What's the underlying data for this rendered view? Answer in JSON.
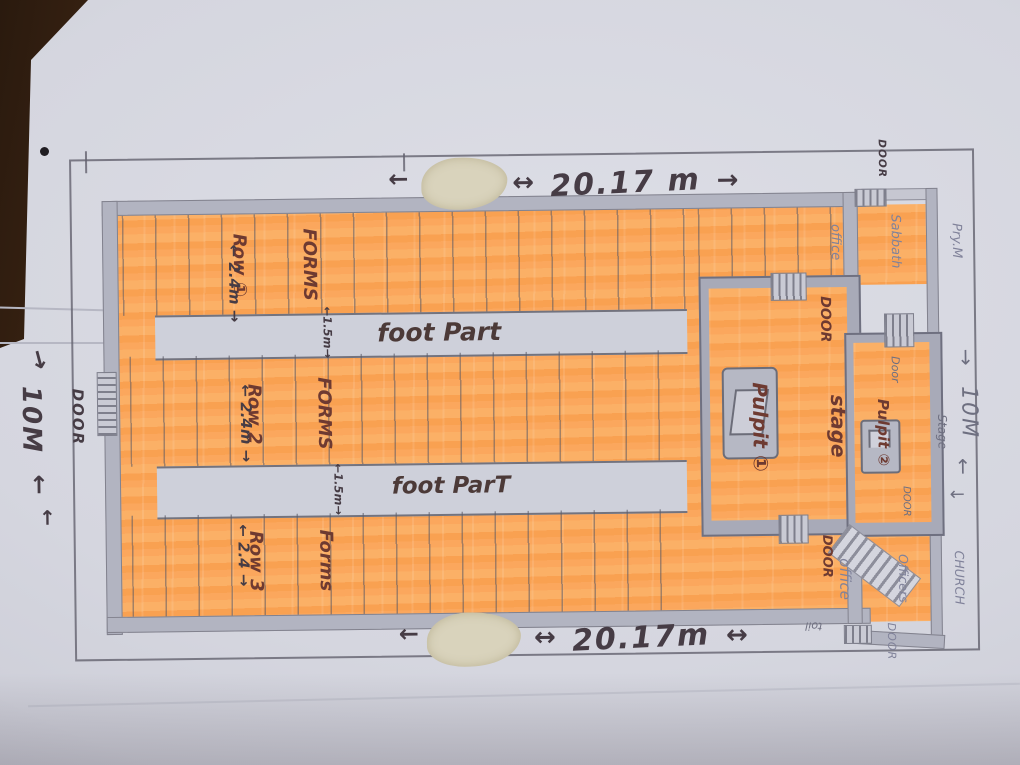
{
  "scene": {
    "description": "Photograph of a hand-drawn church hall floor plan, highlighted in orange marker, on paper lying on a wooden table",
    "colors": {
      "table_wood": "#35200f",
      "paper": "#d5d6df",
      "highlighter_orange": "#faa95c",
      "pencil_gray": "#80829a",
      "marker_brown": "#6e3a31",
      "ink_dark": "#463c45",
      "wall_gray": "#b2b4c1"
    }
  },
  "dimensions": {
    "top": {
      "arrow_left": "←",
      "arrow_mid": "↔",
      "text": "20.17 m",
      "arrow_right": "→"
    },
    "bottom": {
      "arrow_left": "←",
      "arrow_mid": "↔",
      "text": "20.17m",
      "arrow_right": "↔"
    },
    "left": {
      "arrow_top": "↓",
      "text": "10M",
      "arrow_bottom": "↑",
      "arrow_bottom2": "↑"
    },
    "right": {
      "arrow_top": "↓",
      "text": "10M",
      "arrow_bottom": "↑",
      "arrow_side": "←"
    }
  },
  "seating": {
    "rows": [
      {
        "line1": "FORMS",
        "line2": "Row ①",
        "width": "← 2.4m →"
      },
      {
        "line1": "FORMS",
        "line2": "Row 2",
        "width": "← 2.4m →"
      },
      {
        "line1": "Forms",
        "line2": "Row 3",
        "width": "← 2.4 →"
      }
    ],
    "walkways": [
      {
        "label": "foot Part",
        "width": "←1.5m→"
      },
      {
        "label": "foot ParT",
        "width": "←1.5m→"
      }
    ]
  },
  "stage": {
    "stage1": {
      "line1": "stage",
      "line2": "Pulpit ①",
      "door_top": "DOOR",
      "door_bottom": "DOOR"
    },
    "stage2": {
      "line1": "Stage",
      "line2": "Pulpit ②",
      "door_top": "Door",
      "door_bottom": "DOOR"
    }
  },
  "rooms": {
    "sabbath_office": {
      "line1": "Pry.M",
      "line2": "Sabbath",
      "line3": "office"
    },
    "church_office": {
      "line1": "CHURCH",
      "line2": "Officers",
      "line3": "office"
    }
  },
  "doors": {
    "left": "DOOR",
    "top_right": "DOOR",
    "bottom_right": "DOOR"
  },
  "notes": {
    "small_note": "toil"
  }
}
